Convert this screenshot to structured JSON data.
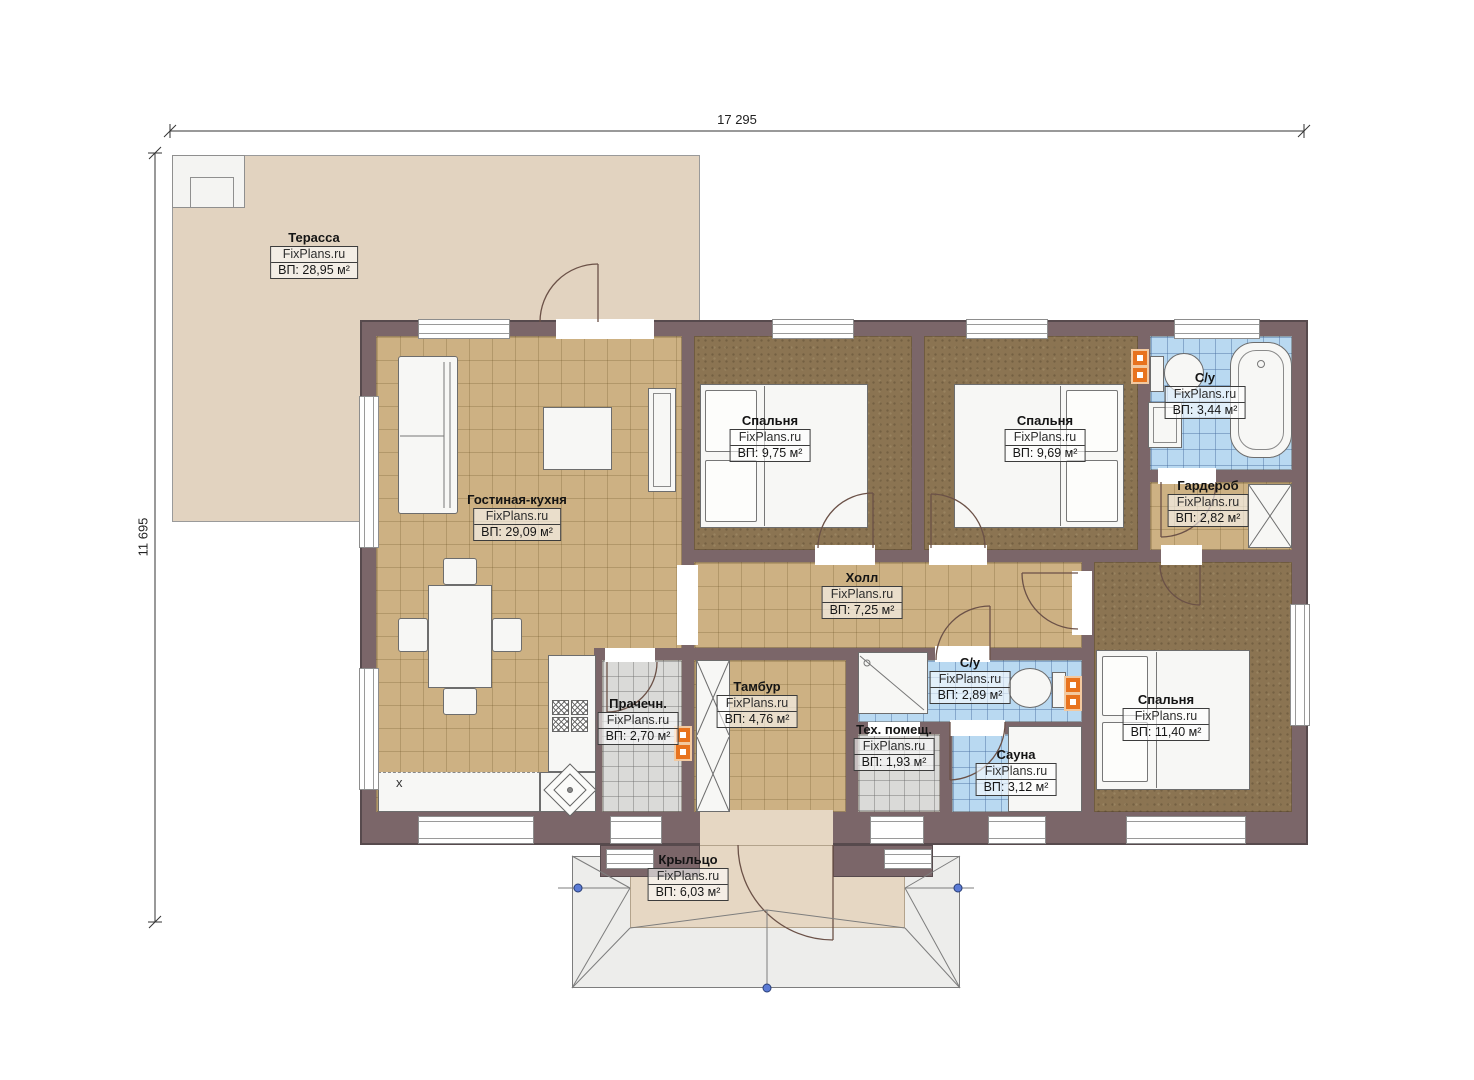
{
  "watermark": "FixPlans.ru",
  "dimensions": {
    "width": "17 295",
    "height": "11 695"
  },
  "rooms": [
    {
      "name": "Терасса",
      "area": "ВП: 28,95 м²"
    },
    {
      "name": "Гостиная-кухня",
      "area": "ВП: 29,09 м²"
    },
    {
      "name": "Спальня",
      "area": "ВП: 9,75 м²"
    },
    {
      "name": "Спальня",
      "area": "ВП: 9,69 м²"
    },
    {
      "name": "С/у",
      "area": "ВП: 3,44 м²"
    },
    {
      "name": "Гардероб",
      "area": "ВП: 2,82 м²"
    },
    {
      "name": "Холл",
      "area": "ВП: 7,25 м²"
    },
    {
      "name": "Тамбур",
      "area": "ВП: 4,76 м²"
    },
    {
      "name": "Прачечн.",
      "area": "ВП: 2,70 м²"
    },
    {
      "name": "С/у",
      "area": "ВП: 2,89 м²"
    },
    {
      "name": "Тех. помещ.",
      "area": "ВП: 1,93 м²"
    },
    {
      "name": "Сауна",
      "area": "ВП: 3,12 м²"
    },
    {
      "name": "Спальня",
      "area": "ВП: 11,40 м²"
    },
    {
      "name": "Крыльцо",
      "area": "ВП: 6,03 м²"
    }
  ],
  "annotations": {
    "kitchen_mark": "x"
  },
  "colors": {
    "wall": "#7b6669",
    "floor_tan": "#cdb183",
    "floor_brown": "#8b7452",
    "floor_blue": "#b9d9f1",
    "floor_gray": "#dadad8",
    "terrace": "#e2d3c0",
    "porch": "#e6d7c3",
    "radiator_orange": "#e8731e",
    "marker_blue": "#5b7bd5"
  }
}
